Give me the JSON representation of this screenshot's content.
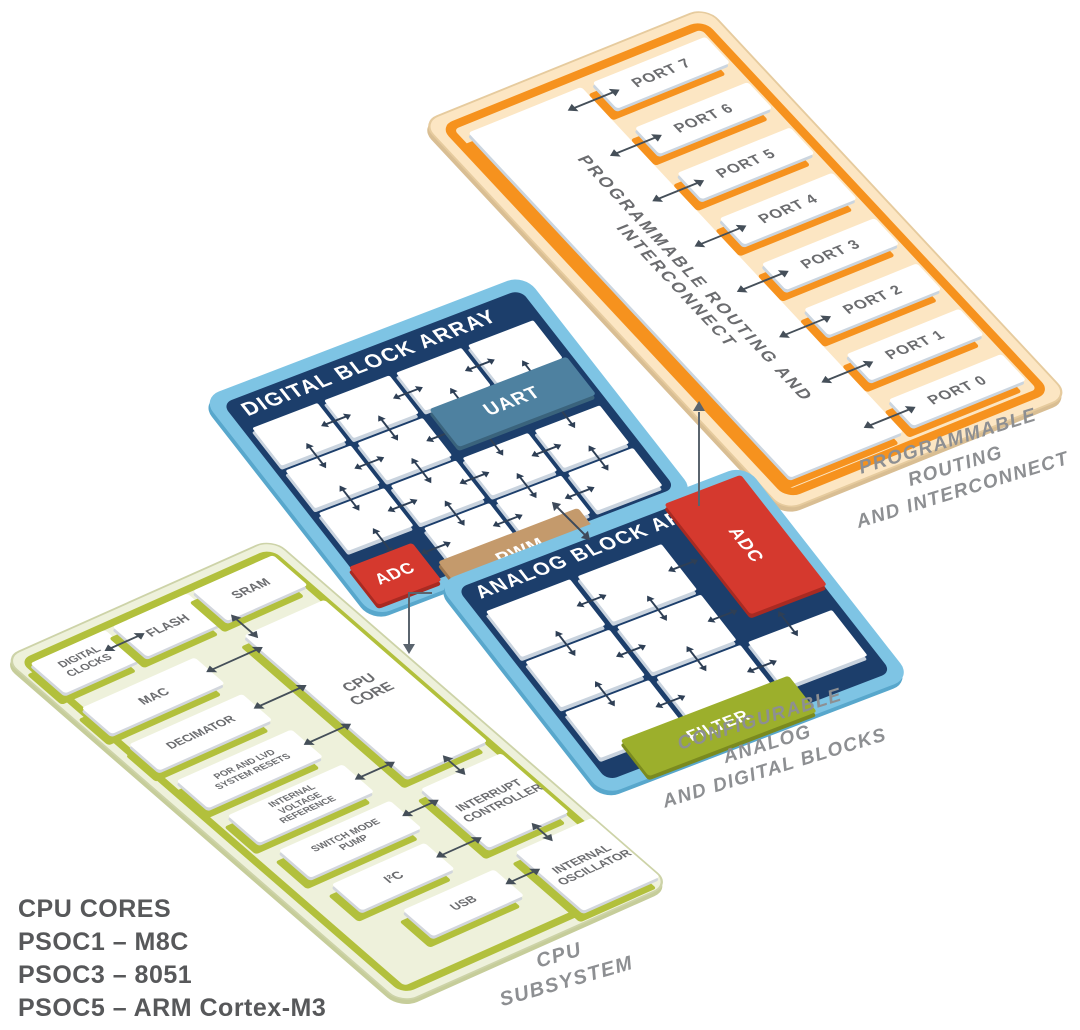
{
  "routing": {
    "bar_label": "PROGRAMMABLE ROUTING AND INTERCONNECT",
    "ports": [
      "PORT 7",
      "PORT 6",
      "PORT 5",
      "PORT 4",
      "PORT 3",
      "PORT 2",
      "PORT 1",
      "PORT 0"
    ],
    "caption": [
      "PROGRAMMABLE ROUTING",
      "AND INTERCONNECT"
    ]
  },
  "digital": {
    "title": "DIGITAL BLOCK ARRAY",
    "uart": "UART",
    "adc": "ADC",
    "pwm": "PWM"
  },
  "analog": {
    "title": "ANALOG BLOCK ARRAY",
    "adc": "ADC",
    "filter": "FILTER",
    "caption": [
      "CONFIGURABLE ANALOG",
      "AND DIGITAL BLOCKS"
    ]
  },
  "cpu": {
    "caption": "CPU SUBSYSTEM",
    "digital_clocks": "DIGITAL CLOCKS",
    "flash": "FLASH",
    "sram": "SRAM",
    "mac": "MAC",
    "decimator": "DECIMATOR",
    "por": "POR AND LVD SYSTEM RESETS",
    "ivr": "INTERNAL VOLTAGE REFERENCE",
    "smp": "SWITCH MODE PUMP",
    "i2c": "I²C",
    "usb": "USB",
    "cpu_core": "CPU CORE",
    "interrupt": "INTERRUPT CONTROLLER",
    "oscillator": "INTERNAL OSCILLATOR"
  },
  "legend": {
    "line1": "CPU CORES",
    "line2": "PSOC1 – M8C",
    "line3": "PSOC3 – 8051",
    "line4": "PSOC5 – ARM Cortex-M3"
  },
  "colors": {
    "orange": "#F6921E",
    "cream": "#FCE6C3",
    "light_blue": "#7EC4E4",
    "navy": "#1C3E6B",
    "red": "#D5392E",
    "tan": "#C49A6C",
    "steel_blue": "#4E81A0",
    "olive": "#9CAF2C",
    "pale_green": "#EEF1DB",
    "olive_plate": "#B2C03C",
    "label_gray": "#6B6C6F",
    "caption_gray": "#8D8F92"
  }
}
